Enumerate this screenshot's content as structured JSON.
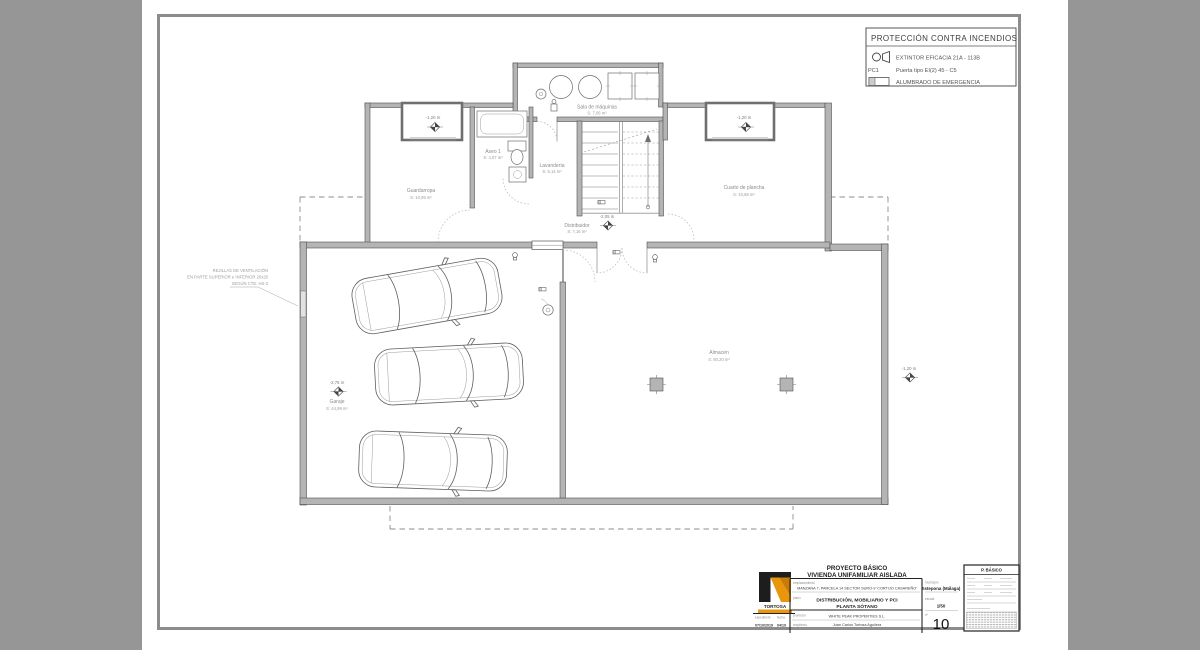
{
  "canvas": {
    "bg": "#969696",
    "sheet_bg": "#ffffff",
    "frame_color": "#8c8c8c",
    "accent_orange": "#e8960c"
  },
  "legend": {
    "title": "PROTECCIÓN CONTRA INCENDIOS",
    "extintor_icon": "extintor-icon",
    "extintor_label": "EXTINTOR EFICACIA 21A - 113B",
    "door_code": "PC1",
    "door_label": "Puerta tipo EI(2) 45 - C5",
    "alumbrado_icon": "alumbrado-icon",
    "alumbrado_label": "ALUMBRADO DE EMERGENCIA"
  },
  "plan": {
    "rooms": {
      "sala": {
        "name": "Sala de máquinas",
        "area": "S: 7,06 m²"
      },
      "aseo": {
        "name": "Aseo 1",
        "area": "S: 4,07 m²"
      },
      "lavanderia": {
        "name": "Lavandería",
        "area": "S: 5,14 m²"
      },
      "guardarropa": {
        "name": "Guardarropa",
        "area": "S: 10,95 m²"
      },
      "plancha": {
        "name": "Cuarto de plancha",
        "area": "S: 10,86 m²"
      },
      "distribuidor": {
        "name": "Distribuidor",
        "area": "S: 7,16 m²"
      },
      "almacen": {
        "name": "Almacén",
        "area": "S: 80,20 m²"
      },
      "garaje": {
        "name": "Garaje",
        "area": "S: 44,99 m²"
      }
    },
    "levels": {
      "lw_left": "-1,20 m",
      "lw_right": "-1,20 m",
      "distribuidor": "-2,05 m",
      "garaje": "-2,75 m",
      "exterior_right": "-1,20 m"
    },
    "annotation": {
      "line1": "REJILLAS DE VENTILACIÓN",
      "line2": "EN PARTE SUPERIOR e INFERIOR 20x20",
      "line3": "SEGÚN CTE. HS-3"
    }
  },
  "titleblock": {
    "project_type": "PROYECTO BÁSICO",
    "project_name": "VIVIENDA UNIFAMILIAR AISLADA",
    "emplazamiento_label": "emplazamiento",
    "emplazamiento": "MANZANA 7, PARCELA 14 SECTOR SURO-9 'CORTIJO CASAREÑO'",
    "plano_label": "plano",
    "plano_line1": "DISTRIBUCIÓN, MOBILIARIO Y PCI",
    "plano_line2": "PLANTA SÓTANO",
    "promotor_label": "promotor",
    "promotor": "WHITE PEAK PROPERTIES S.L.",
    "arquitecto_label": "arquitecto",
    "arquitecto": "Juan Carlos Tortosa Aguilera",
    "municipio_label": "municipio",
    "municipio": "Estepona (Málaga)",
    "escala_label": "escala",
    "escala": "1/50",
    "numero_label": "nº",
    "numero": "10",
    "expediente_label": "expediente",
    "expediente": "07/10/2019",
    "fecha_label": "fecha",
    "fecha": "04/19",
    "logo_text": "TORTOSA",
    "stamp_title": "P. BÁSICO"
  }
}
